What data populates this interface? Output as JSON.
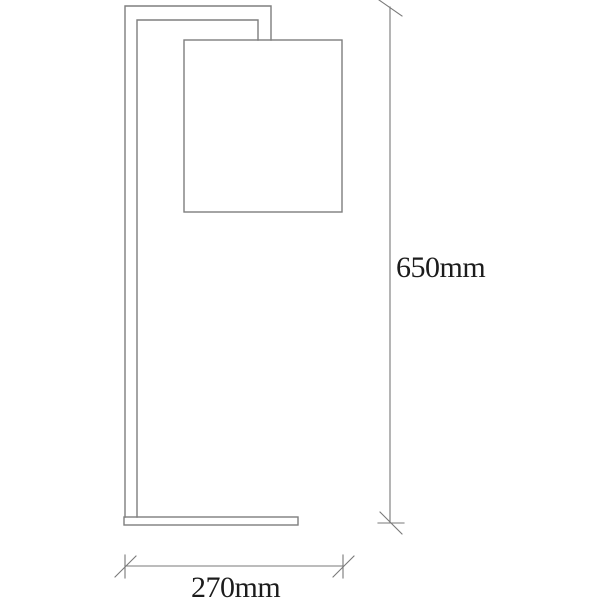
{
  "drawing": {
    "title": "floor-lamp-technical-drawing",
    "view": "side elevation with overall dimensions",
    "parts": {
      "frame": "L-shaped lamp frame (vertical pole with top arm)",
      "shade": "rectangular lamp shade hanging from arm",
      "base": "flat rectangular foot plate"
    },
    "dimensions": {
      "height_label": "650mm",
      "width_label": "270mm"
    },
    "colors": {
      "background": "#ffffff",
      "outline_stroke": "#7e7e7e",
      "dimension_stroke": "#787878",
      "label_text": "#1c1c1c"
    }
  }
}
